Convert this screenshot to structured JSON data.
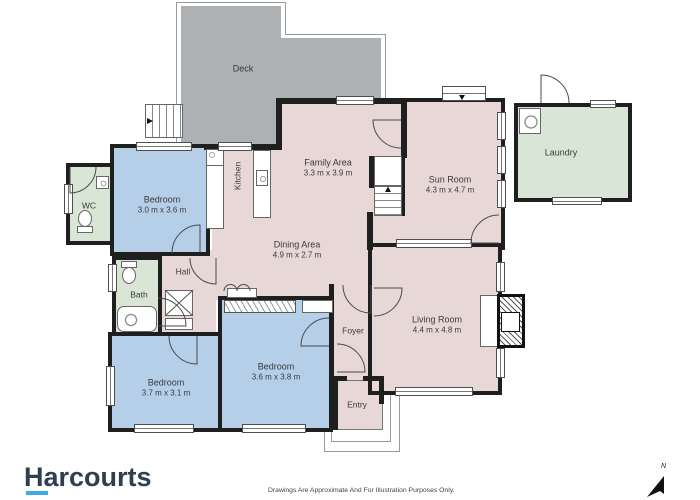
{
  "brand": {
    "logo_text": "Harcourts"
  },
  "footer": {
    "disclaimer": "Drawings Are Approximate And For Illustration Purposes Only."
  },
  "compass": {
    "north_label": "N"
  },
  "colors": {
    "room_pink": "#e7d8d7",
    "room_blue": "#b6cfe9",
    "room_green": "#d9e6d6",
    "deck_gray": "#aeb1b4",
    "wall_black": "#1f1f1f",
    "brand_navy": "#2e3f52",
    "brand_blue": "#3fa9e1"
  },
  "rooms": {
    "deck": {
      "label": "Deck"
    },
    "wc": {
      "label": "WC"
    },
    "bedroom_top": {
      "label": "Bedroom",
      "dims": "3.0 m x 3.6 m"
    },
    "kitchen": {
      "label": "Kitchen"
    },
    "family": {
      "label": "Family Area",
      "dims": "3.3 m x 3.9 m"
    },
    "dining": {
      "label": "Dining Area",
      "dims": "4.9 m x 2.7 m"
    },
    "sunroom": {
      "label": "Sun Room",
      "dims": "4.3 m x 4.7 m"
    },
    "laundry": {
      "label": "Laundry"
    },
    "living": {
      "label": "Living Room",
      "dims": "4.4 m x 4.8 m"
    },
    "hall": {
      "label": "Hall"
    },
    "bath": {
      "label": "Bath"
    },
    "bedroom_left": {
      "label": "Bedroom",
      "dims": "3.7 m x 3.1 m"
    },
    "bedroom_mid": {
      "label": "Bedroom",
      "dims": "3.6 m x 3.8 m"
    },
    "foyer": {
      "label": "Foyer"
    },
    "entry": {
      "label": "Entry"
    }
  }
}
